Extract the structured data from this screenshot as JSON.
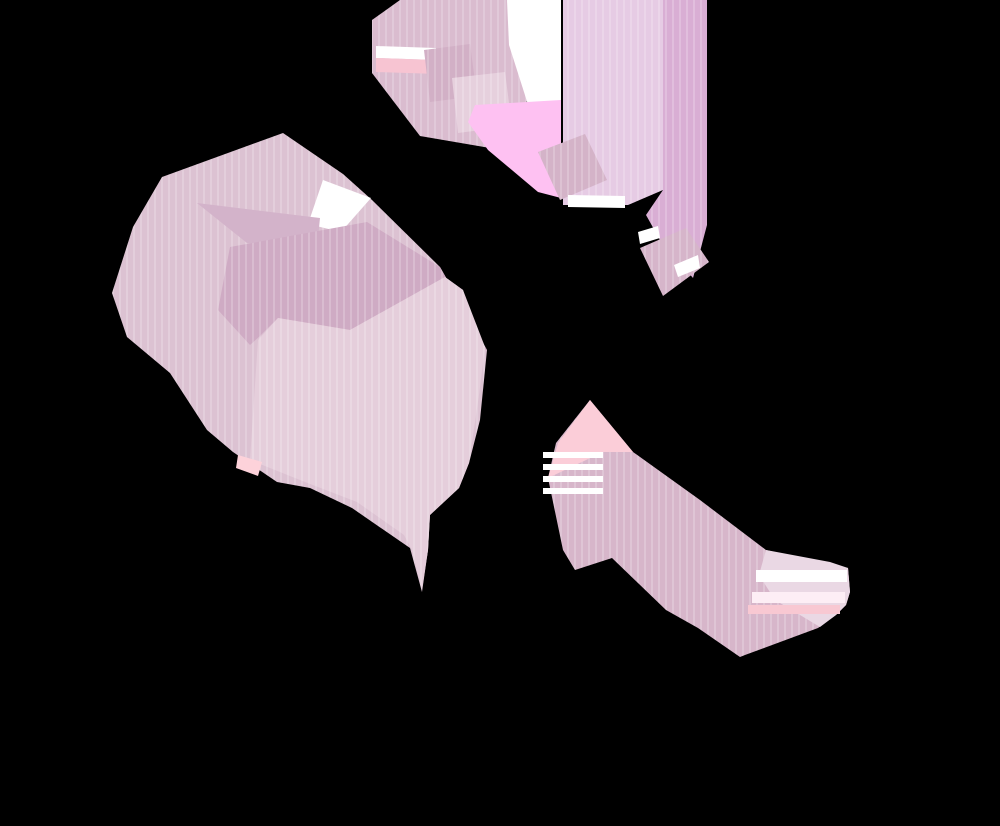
{
  "artwork": {
    "canvas_width": 1000,
    "canvas_height": 826,
    "background_color": "#000000",
    "palette": {
      "base_mauve": "#dcc2d2",
      "band_mauve": "#dabccf",
      "dark_mauve": "#cfabc4",
      "patch_mauve": "#d3b3ca",
      "light_pink_square": "#e5cedb",
      "pale_lilac": "#e6cbe4",
      "pink_column": "#d9aed4",
      "slab_mauve": "#d7b6ca",
      "slab_pale": "#ead8e4",
      "bright_pink": "#fec1f2",
      "peach": "#f7c4d2",
      "peach_light": "#fbcdd8",
      "white_highlight": "#ffffff"
    },
    "stripe_texture": {
      "tile_width": 7,
      "line_width": 2,
      "line_color": "rgba(255,255,255,0.20)"
    },
    "shapes": [
      {
        "name": "top-band-main",
        "fill": "#dabccf",
        "stripes": true,
        "points": "400,0 507,0 522,40 528,100 490,148 420,136 372,73 372,20"
      },
      {
        "name": "top-band-white-sliver",
        "fill": "#ffffff",
        "stripes": false,
        "points": "376,46 436,48 436,60 376,58"
      },
      {
        "name": "top-band-peach-stripe",
        "fill": "#f7c4d2",
        "stripes": false,
        "points": "376,58 436,60 438,74 376,72"
      },
      {
        "name": "top-band-dark-square",
        "fill": "#d2b0c6",
        "stripes": true,
        "points": "424,50 470,44 477,96 430,102"
      },
      {
        "name": "top-band-light-square",
        "fill": "#e6d0dd",
        "stripes": true,
        "points": "452,78 505,72 512,126 458,133"
      },
      {
        "name": "white-column",
        "fill": "#ffffff",
        "stripes": false,
        "points": "507,0 561,0 561,100 531,114 509,45"
      },
      {
        "name": "bright-pink-block",
        "fill": "#fec1f2",
        "stripes": false,
        "points": "475,105 561,100 561,198 538,192 488,150 468,122"
      },
      {
        "name": "lilac-column",
        "fill": "#e6cbe4",
        "stripes": true,
        "points": "563,0 663,0 663,190 628,205 563,205"
      },
      {
        "name": "pink-column-right",
        "fill": "#d9aed4",
        "stripes": true,
        "points": "663,0 707,0 707,225 693,278 660,240 646,215 663,190"
      },
      {
        "name": "dash-square-third",
        "fill": "#d4b3c8",
        "stripes": true,
        "points": "538,152 585,134 607,180 560,200"
      },
      {
        "name": "white-sliver-below-third",
        "fill": "#ffffff",
        "stripes": false,
        "points": "568,195 625,196 625,208 568,207"
      },
      {
        "name": "dash-square-fourth",
        "fill": "#d6b5ca",
        "stripes": true,
        "points": "640,248 686,228 709,262 663,296"
      },
      {
        "name": "white-sliver-fourth-left",
        "fill": "#ffffff",
        "stripes": false,
        "points": "638,232 658,226 660,238 640,244"
      },
      {
        "name": "white-sliver-fourth-inner",
        "fill": "#ffffff",
        "stripes": false,
        "points": "674,265 698,255 700,268 678,277"
      },
      {
        "name": "left-blob-base",
        "fill": "#dcc2d2",
        "stripes": true,
        "points": "283,133 343,174 372,200 440,267 487,350 480,420 469,463 459,488 430,515 428,550 422,592 410,548 352,508 310,488 277,482 233,452 207,430 170,373 127,337 112,293 133,227 162,177"
      },
      {
        "name": "blob-white-wedge",
        "fill": "#ffffff",
        "stripes": false,
        "points": "323,180 371,198 341,232 308,224"
      },
      {
        "name": "blob-top-patch",
        "fill": "#d3b3ca",
        "stripes": false,
        "points": "197,203 320,218 317,248 247,243"
      },
      {
        "name": "blob-dark-arrow",
        "fill": "#cfabc4",
        "stripes": true,
        "points": "230,247 367,222 440,267 487,350 472,345 463,290 445,277 350,330 278,318 260,336 250,345 218,310"
      },
      {
        "name": "central-light-square",
        "fill": "#e5cedb",
        "stripes": true,
        "points": "278,318 350,330 445,277 463,290 485,347 479,395 472,442 469,463 459,488 430,515 428,550 422,590 412,550 404,535 357,502 305,482 250,460 258,340"
      },
      {
        "name": "blob-peach-corner",
        "fill": "#fdd2da",
        "stripes": false,
        "points": "238,455 262,462 258,476 236,468"
      },
      {
        "name": "bottom-slab-base",
        "fill": "#d7b6ca",
        "stripes": true,
        "points": "590,400 633,452 700,500 766,550 830,565 848,568 850,592 846,605 836,615 818,628 745,655 740,657 698,628 666,610 612,558 575,570 563,550 548,478 556,443"
      },
      {
        "name": "slab-peach-triangle",
        "fill": "#fbcdd8",
        "stripes": false,
        "points": "590,400 633,452 603,452 548,478 558,443"
      },
      {
        "name": "slab-white-strip-1",
        "fill": "#ffffff",
        "stripes": false,
        "points": "543,452 603,452 603,458 543,458"
      },
      {
        "name": "slab-white-strip-2",
        "fill": "#ffffff",
        "stripes": false,
        "points": "543,464 603,464 603,470 543,470"
      },
      {
        "name": "slab-white-strip-3",
        "fill": "#ffffff",
        "stripes": false,
        "points": "543,476 603,476 603,482 543,482"
      },
      {
        "name": "slab-white-strip-4",
        "fill": "#ffffff",
        "stripes": false,
        "points": "543,488 603,488 603,494 543,494"
      },
      {
        "name": "slab-pale-end",
        "fill": "#ead8e4",
        "stripes": false,
        "points": "766,550 830,562 848,568 850,592 846,605 836,615 820,627 775,600 759,575"
      },
      {
        "name": "slab-end-white-stripe-1",
        "fill": "#ffffff",
        "stripes": false,
        "points": "756,570 847,570 847,582 756,582"
      },
      {
        "name": "slab-end-white-stripe-2",
        "fill": "#fdeef5",
        "stripes": false,
        "points": "752,592 845,592 845,603 752,603"
      },
      {
        "name": "slab-end-salmon-stripe",
        "fill": "#f8c8d2",
        "stripes": false,
        "points": "748,605 840,605 840,614 748,614"
      }
    ]
  }
}
